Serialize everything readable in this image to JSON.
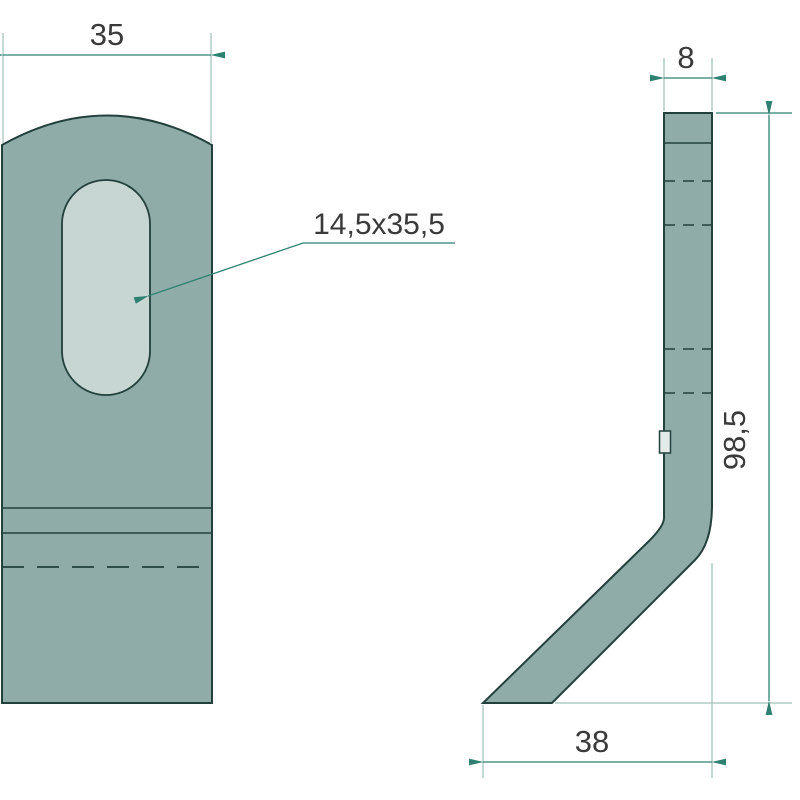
{
  "drawing": {
    "type": "technical-drawing",
    "subject": "bent flail blade, two orthographic views",
    "views": {
      "front": "front-view-with-slotted-hole",
      "side": "side-profile-bent-strip"
    },
    "dimensions": {
      "width": "35",
      "slot": "14,5x35,5",
      "thickness": "8",
      "height": "98,5",
      "leg": "38"
    },
    "colors": {
      "bg": "#ffffff",
      "body": "#8FACA9",
      "slot": "#C7D6D2",
      "outline": "#22403C",
      "dim": "#2E8170",
      "ext": "#9FBFB9",
      "text": "#3A3A3A",
      "notch": "#E3EAE8"
    }
  }
}
